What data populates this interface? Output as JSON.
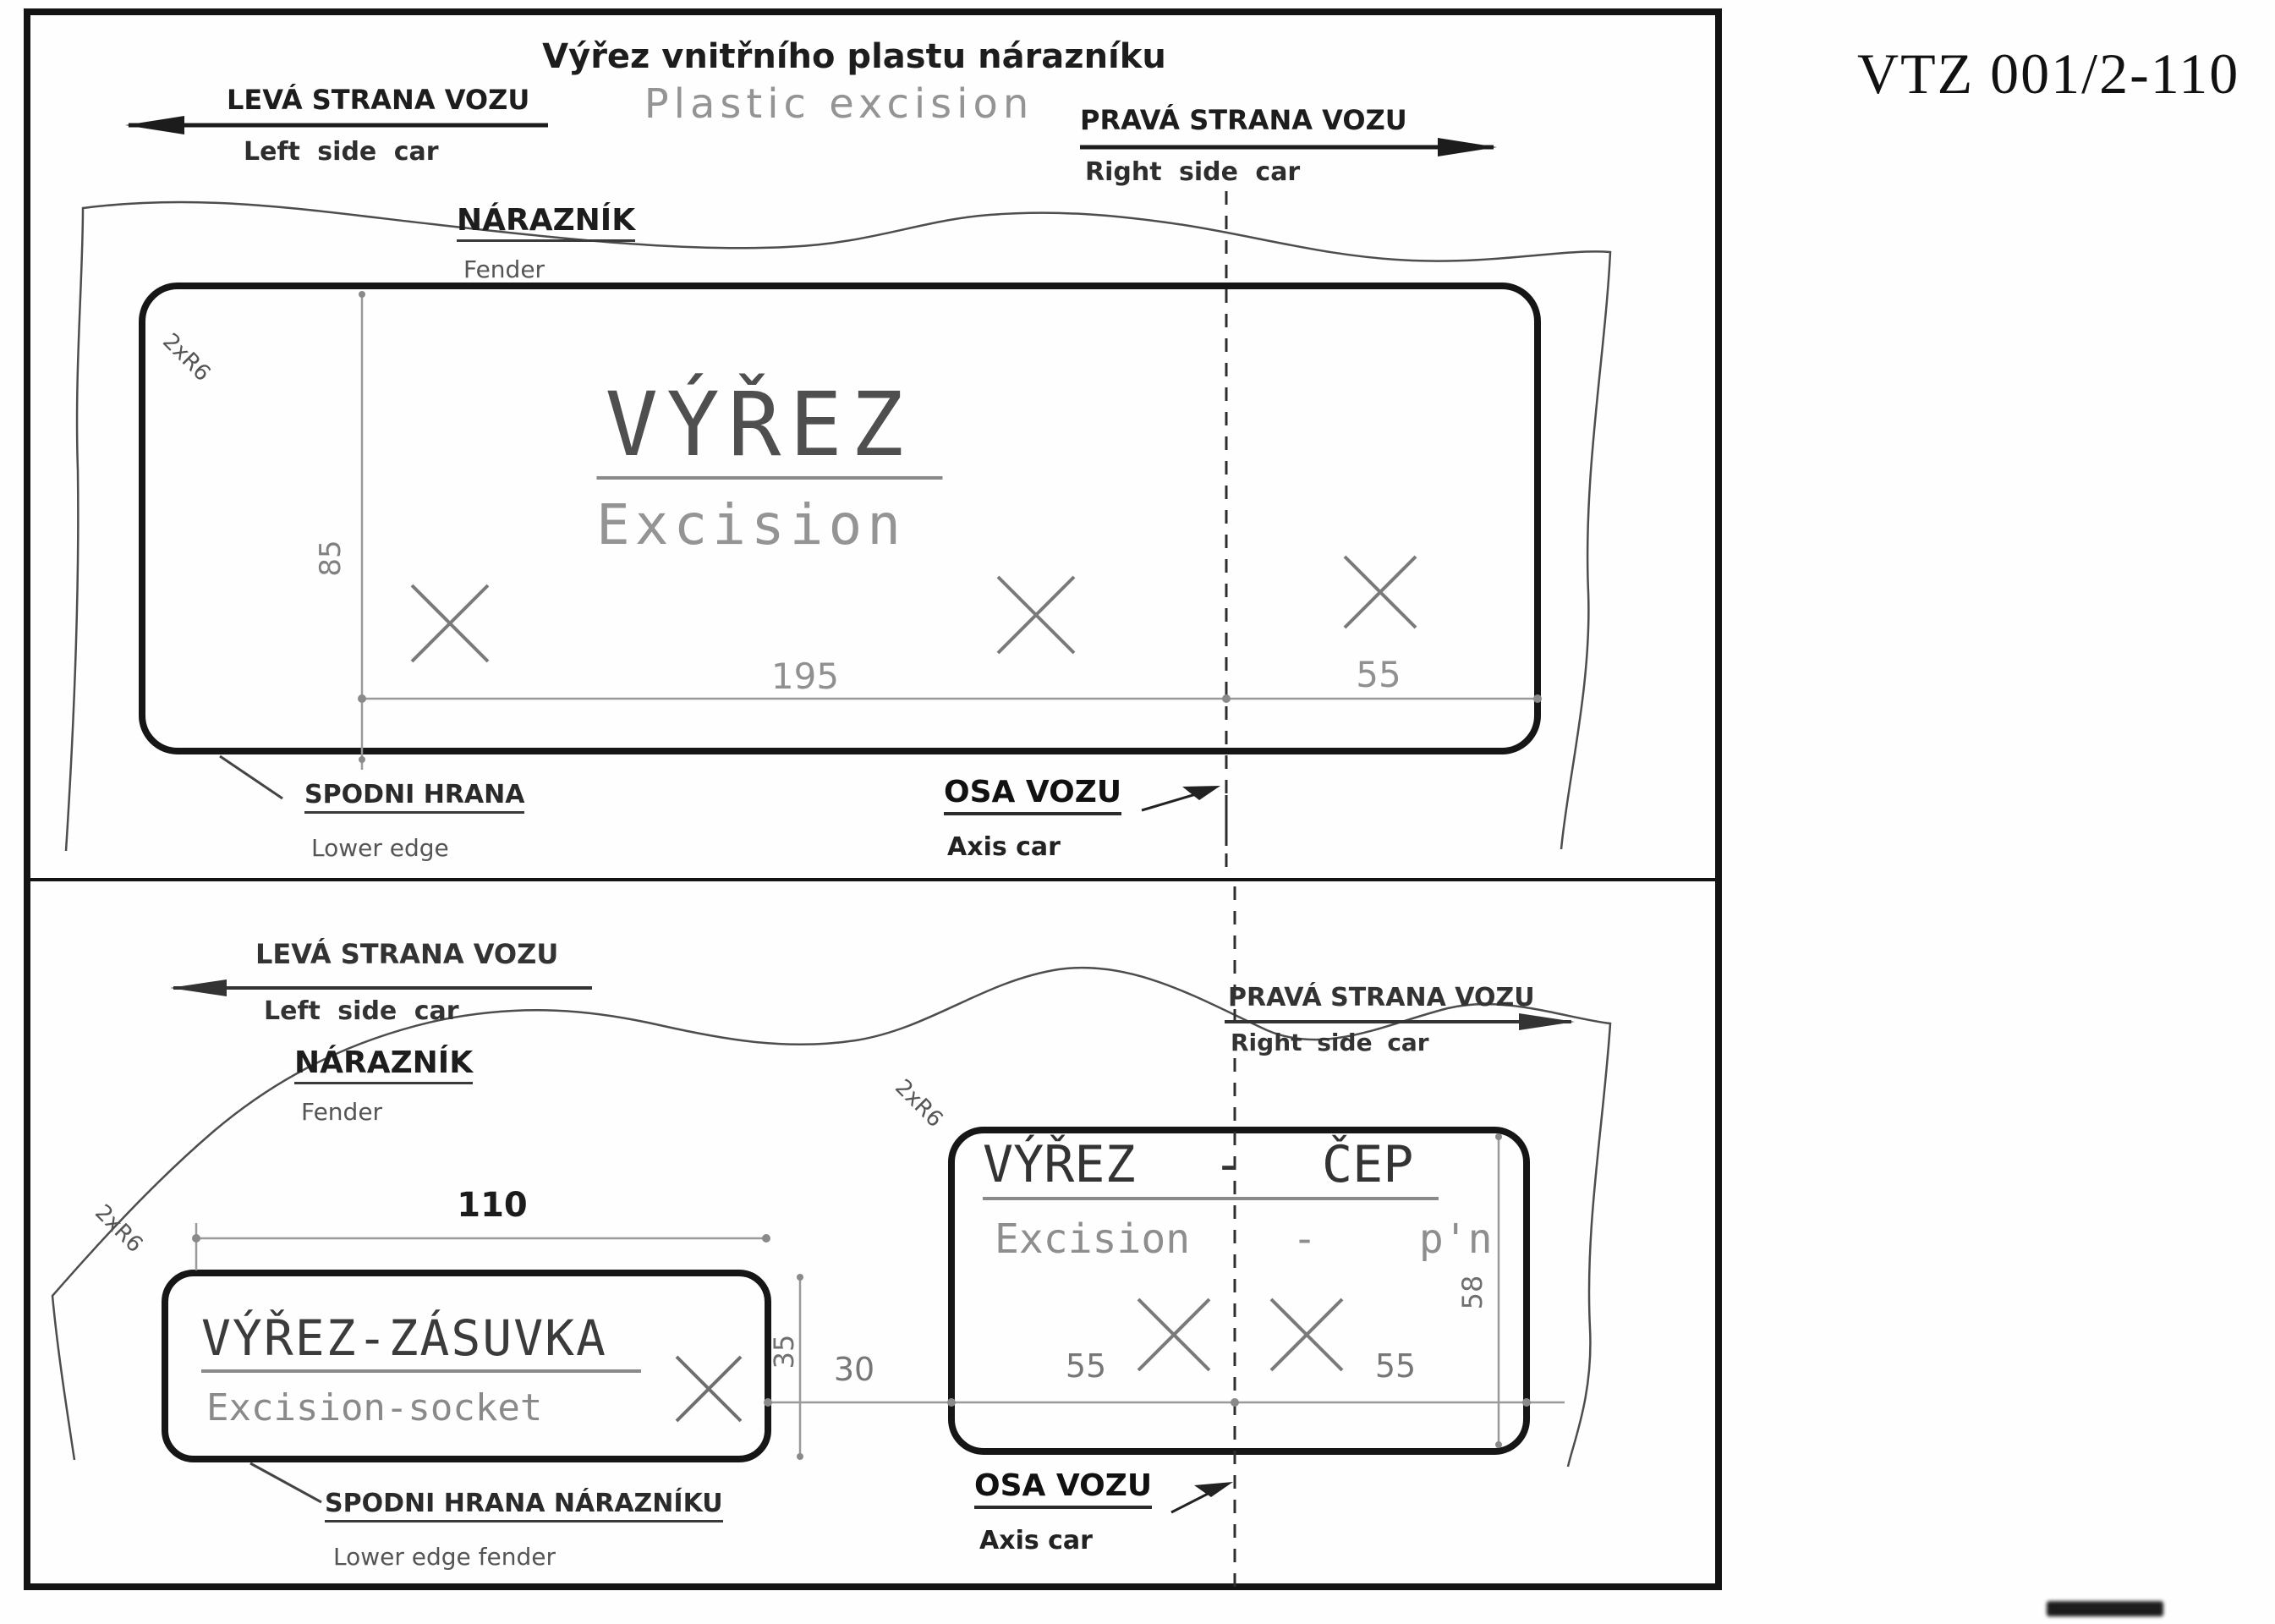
{
  "doc_number": "VTZ 001/2-110",
  "title": {
    "cz": "Výřez vnitřního plastu nárazníku",
    "en": "Plastic  excision"
  },
  "top": {
    "left": {
      "cz": "LEVÁ STRANA VOZU",
      "en": "Left side car"
    },
    "right": {
      "cz": "PRAVÁ STRANA VOZU",
      "en": "Right side car"
    },
    "fender": {
      "cz": "NÁRAZNÍK",
      "en": "Fender"
    },
    "excision": {
      "cz": "VÝŘEZ",
      "en": "Excision"
    },
    "lower_edge": {
      "cz": "SPODNI HRANA",
      "en": "Lower edge"
    },
    "axis": {
      "cz": "OSA VOZU",
      "en": "Axis car"
    },
    "dims": {
      "height": "85",
      "width": "195",
      "offset": "55",
      "radius": "2xR6"
    }
  },
  "bottom": {
    "left": {
      "cz": "LEVÁ STRANA VOZU",
      "en": "Left side car"
    },
    "right": {
      "cz": "PRAVÁ STRANA VOZU",
      "en": "Right side car"
    },
    "fender": {
      "cz": "NÁRAZNÍK",
      "en": "Fender"
    },
    "socket": {
      "cz": "VÝŘEZ-ZÁSUVKA",
      "en": "Excision-socket"
    },
    "pin": {
      "cz": "VÝŘEZ - ČEP",
      "en": "Excision - p'n"
    },
    "lower_edge": {
      "cz": "SPODNI HRANA NÁRAZNÍKU",
      "en": "Lower edge fender"
    },
    "axis": {
      "cz": "OSA VOZU",
      "en": "Axis car"
    },
    "dims": {
      "socket_width": "110",
      "socket_height": "35",
      "gap": "30",
      "pin_left": "55",
      "pin_right": "55",
      "pin_height": "58",
      "socket_radius": "2xR6",
      "pin_radius": "2xR6",
      "top_radius": "2xR6"
    }
  },
  "colors": {
    "ink": "#1d1d1d",
    "dim": "#9a9a9a",
    "gray_text": "#949494"
  }
}
